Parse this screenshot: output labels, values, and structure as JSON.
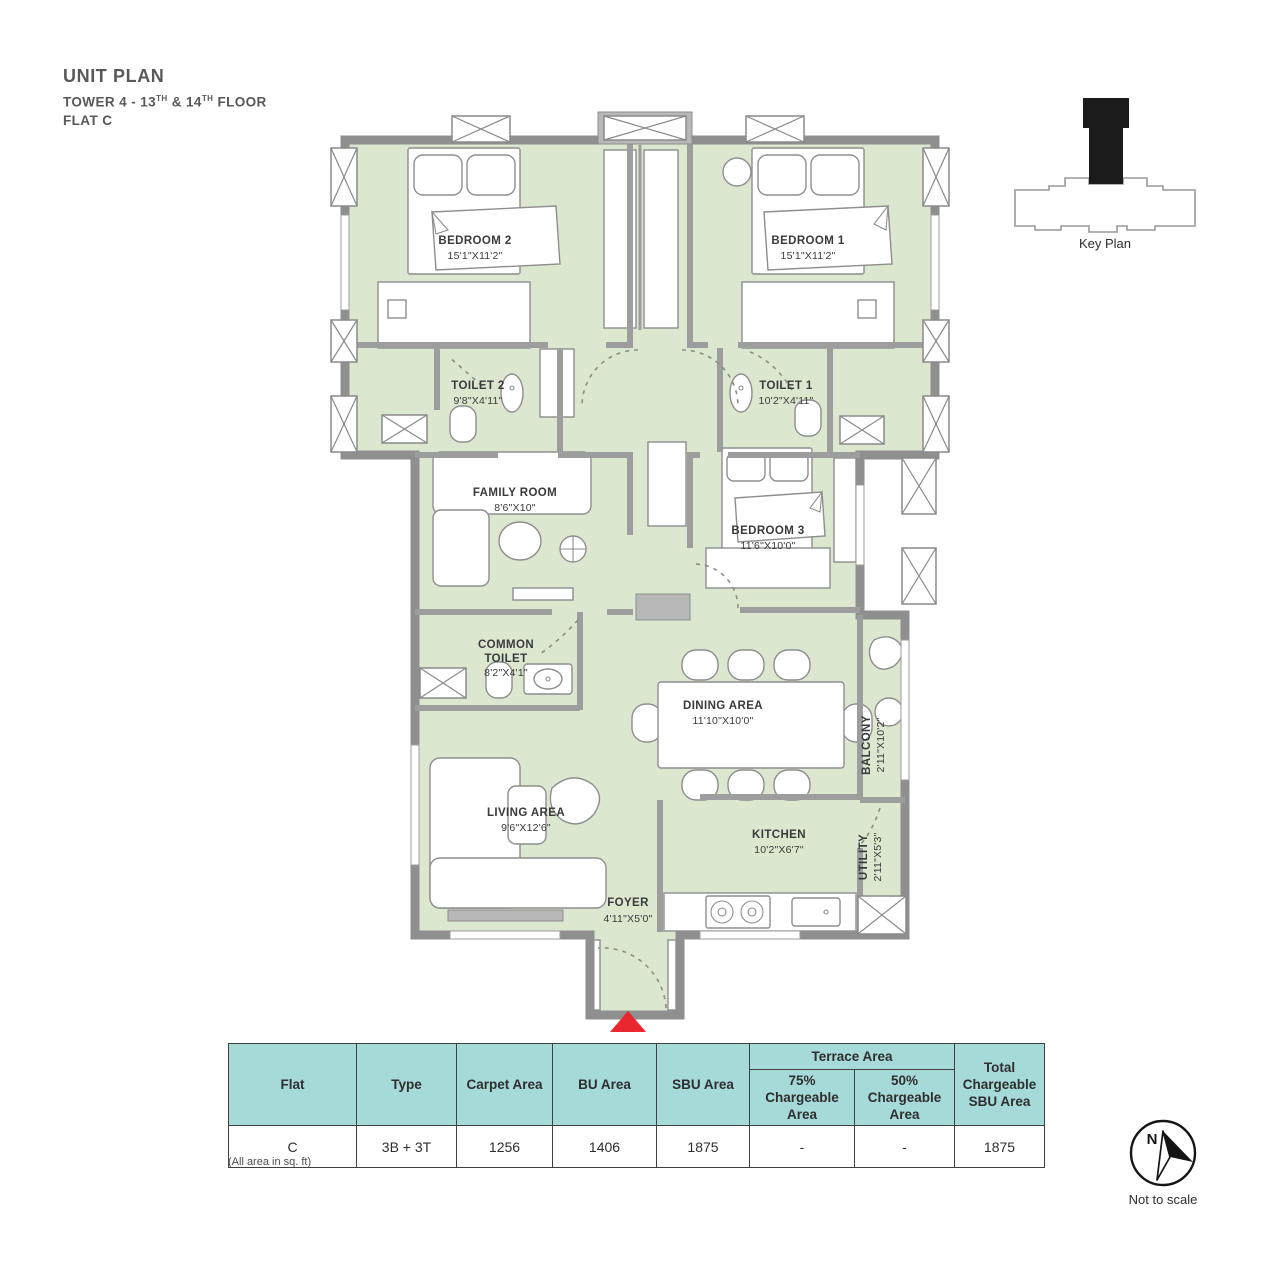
{
  "header": {
    "title": "UNIT PLAN",
    "tower_prefix": "TOWER 4 - 13",
    "sup1": "TH",
    "tower_mid": " & 14",
    "sup2": "TH",
    "tower_suffix": " FLOOR",
    "flat": "FLAT C"
  },
  "key_plan": {
    "label": "Key Plan"
  },
  "compass": {
    "letter": "N",
    "note": "Not to scale"
  },
  "plan": {
    "rooms": {
      "bedroom2": {
        "name": "BEDROOM 2",
        "dims": "15'1\"X11'2\""
      },
      "bedroom1": {
        "name": "BEDROOM 1",
        "dims": "15'1\"X11'2\""
      },
      "toilet2": {
        "name": "TOILET 2",
        "dims": "9'8\"X4'11\""
      },
      "toilet1": {
        "name": "TOILET 1",
        "dims": "10'2\"X4'11\""
      },
      "family_room": {
        "name": "FAMILY ROOM",
        "dims": "8'6\"X10\""
      },
      "bedroom3": {
        "name": "BEDROOM 3",
        "dims": "11'6\"X10'0\""
      },
      "common_toilet": {
        "line1": "COMMON",
        "line2": "TOILET",
        "dims": "8'2\"X4'1\""
      },
      "dining": {
        "name": "DINING AREA",
        "dims": "11'10\"X10'0\""
      },
      "balcony": {
        "name": "BALCONY",
        "dims": "2'11\"X10'2\""
      },
      "living": {
        "name": "LIVING AREA",
        "dims": "9'6\"X12'6\""
      },
      "kitchen": {
        "name": "KITCHEN",
        "dims": "10'2\"X6'7\""
      },
      "utility": {
        "name": "UTILITY",
        "dims": "2'11\"X5'3\""
      },
      "foyer": {
        "name": "FOYER",
        "dims": "4'11\"X5'0\""
      }
    },
    "colors": {
      "room_fill": "#dbe7ce",
      "wall": "#9d9d9d",
      "entry_arrow": "#e8272e",
      "table_header_bg": "#a6dad8"
    }
  },
  "table": {
    "headers": {
      "flat": "Flat",
      "type": "Type",
      "carpet": "Carpet Area",
      "bu": "BU Area",
      "sbu": "SBU Area",
      "terrace": "Terrace Area",
      "t75": "75% Chargeable Area",
      "t50": "50% Chargeable Area",
      "total": "Total Chargeable SBU Area"
    },
    "row": {
      "flat": "C",
      "type": "3B + 3T",
      "carpet": "1256",
      "bu": "1406",
      "sbu": "1875",
      "t75": "-",
      "t50": "-",
      "total": "1875"
    }
  },
  "note": "(All area in sq. ft)"
}
